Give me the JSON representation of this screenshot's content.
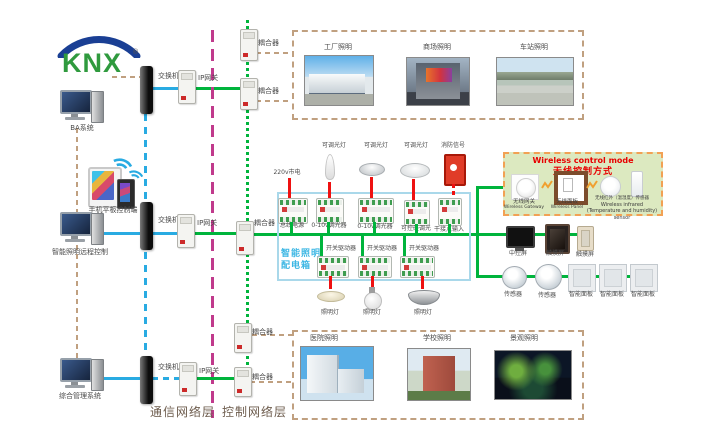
{
  "logo": {
    "text": "KNX",
    "reg": "®"
  },
  "left": {
    "computer1_label": "BA系统",
    "mobile_label": "手机平板控制端",
    "computer2_label": "智能照明远程控制",
    "computer3_label": "综合管理系统"
  },
  "network": {
    "switch_label": "交换机",
    "gateway_label": "IP网关",
    "coupler_label": "耦合器",
    "comm_layer": "通信网络层",
    "ctrl_layer": "控制网络层"
  },
  "top_photos": {
    "items": [
      {
        "label": "工厂照明"
      },
      {
        "label": "商场照明"
      },
      {
        "label": "车站照明"
      }
    ]
  },
  "bottom_photos": {
    "items": [
      {
        "label": "医院照明"
      },
      {
        "label": "学校照明"
      },
      {
        "label": "景观照明"
      }
    ]
  },
  "panel": {
    "title_line1": "智能照明",
    "title_line2": "配电箱",
    "power_label": "220v市电",
    "top_lamps": [
      {
        "label": "可调光灯"
      },
      {
        "label": "可调光灯"
      },
      {
        "label": "可调光灯"
      },
      {
        "label": "消防信号"
      }
    ],
    "row1": [
      {
        "label": "总线电源"
      },
      {
        "label": "0-10v调光器"
      },
      {
        "label": "0-10v调光器"
      },
      {
        "label": "可控硅调光"
      },
      {
        "label": "干接点输入"
      }
    ],
    "row2": [
      {
        "label": "开关驱动器"
      },
      {
        "label": "开关驱动器"
      },
      {
        "label": "开关驱动器"
      }
    ],
    "bottom_lamps": [
      {
        "label": "照明灯"
      },
      {
        "label": "照明灯"
      },
      {
        "label": "照明灯"
      }
    ]
  },
  "wireless": {
    "title_en": "Wireless control mode",
    "title_zh": "无线控制方式",
    "items": [
      {
        "zh": "无线网关",
        "en": "Wireless Gateway"
      },
      {
        "zh": "无线面板",
        "en": "Wireless Panel"
      },
      {
        "zh": "无线红外（温湿度）传感器",
        "en": "Wireless infrared (Temperature and humidity) sensor"
      }
    ]
  },
  "right": {
    "screens": [
      {
        "label": "中控屏"
      },
      {
        "label": "触摸屏"
      },
      {
        "label": "触摸屏"
      }
    ],
    "sensors": [
      {
        "label": "传感器"
      },
      {
        "label": "传感器"
      }
    ],
    "smart_panels": [
      {
        "label": "智能面板"
      },
      {
        "label": "智能面板"
      },
      {
        "label": "智能面板"
      }
    ]
  },
  "colors": {
    "bus_green": "#00b43c",
    "comm_blue": "#29abe2",
    "layer_purple": "#c03a8c",
    "link_tan": "#c0a080",
    "signal_red": "#ee1111",
    "panel_blue": "#3db7e4",
    "wireless_bg": "#dce9c0",
    "wireless_border": "#f2a154",
    "wireless_title_red": "#e80000"
  }
}
